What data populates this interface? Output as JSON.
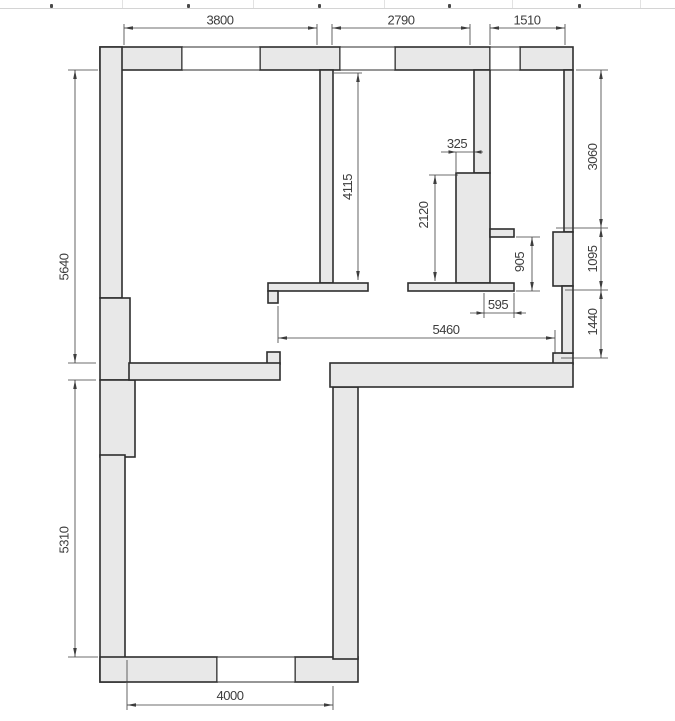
{
  "floorplan": {
    "type": "architectural-floor-plan",
    "colors": {
      "wall_fill": "#e8e8e8",
      "wall_outline": "#2e2e2e",
      "dimension_color": "#3d3d3d",
      "background": "#ffffff",
      "header_strip_line": "#d4d4d4"
    },
    "dimensions": {
      "top": [
        "3800",
        "2790",
        "1510"
      ],
      "left": [
        "5640",
        "5310"
      ],
      "right": [
        "3060",
        "1095",
        "1440"
      ],
      "bottom": [
        "4000"
      ],
      "interior": [
        "4115",
        "2120",
        "325",
        "905",
        "595",
        "5460"
      ]
    }
  }
}
